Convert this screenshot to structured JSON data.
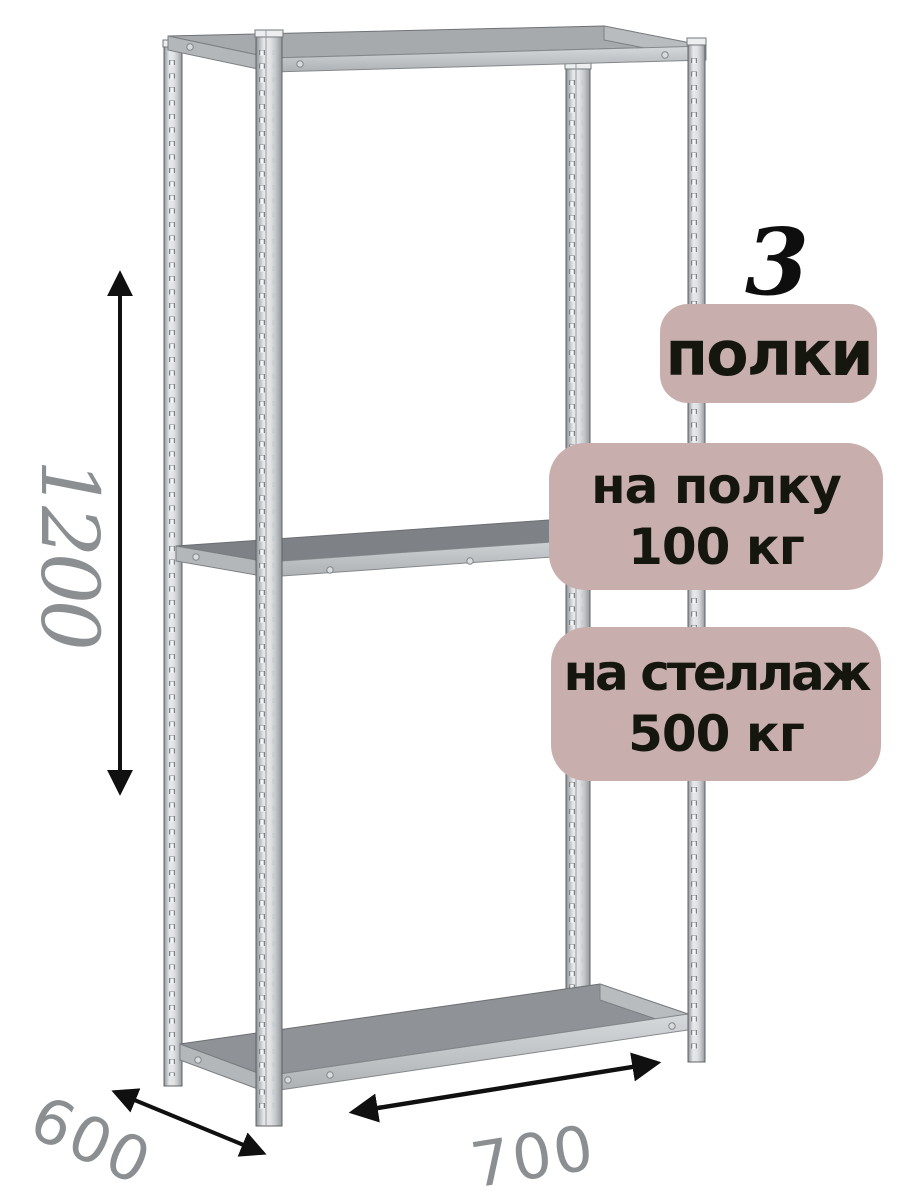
{
  "annotation": {
    "shelf_count": "3",
    "shelves_badge": {
      "label": "полки"
    },
    "shelf_load_badge": {
      "line1": "на полку",
      "line2": "100 кг"
    },
    "rack_load_badge": {
      "line1": "на стеллаж",
      "line2": "500 кг"
    }
  },
  "dimensions": {
    "height_mm": "1200",
    "depth_mm": "600",
    "width_mm": "700"
  },
  "colors": {
    "badge_bg": "#c8afad",
    "badge_text": "#15170f",
    "dimension_text": "#8c8f92",
    "arrow": "#101010",
    "shelf_surface": "#8f9296",
    "metal_light": "#e6e8ea",
    "metal_dark": "#898c8f"
  }
}
